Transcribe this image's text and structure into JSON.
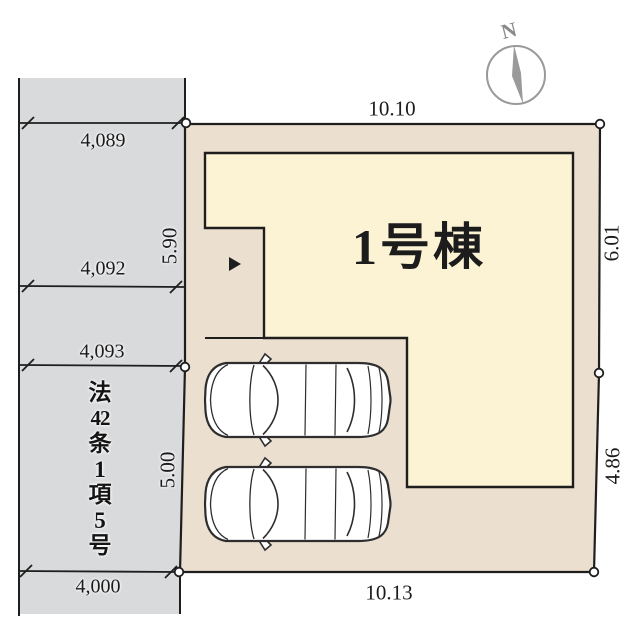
{
  "diagram_type": "real-estate-plot-plan",
  "compass": {
    "north_label": "N"
  },
  "building": {
    "label": "1号棟"
  },
  "road": {
    "law_label": "法42条1項5号",
    "law_label_chars": [
      "法",
      "42",
      "条",
      "1",
      "項",
      "5",
      "号"
    ],
    "width_labels": [
      "4,089",
      "4,092",
      "4,093",
      "4,000"
    ]
  },
  "dimensions": {
    "top": "10.10",
    "bottom": "10.13",
    "left_upper": "5.90",
    "left_lower": "5.00",
    "right_upper": "6.01",
    "right_lower": "4.86"
  },
  "colors": {
    "plot_fill": "#ebdfcf",
    "building_fill": "#fcf3d5",
    "road_fill": "#d9dadc",
    "outline": "#1e1e1e",
    "compass_gray": "#999999",
    "car_outline": "#2e2e2e"
  }
}
